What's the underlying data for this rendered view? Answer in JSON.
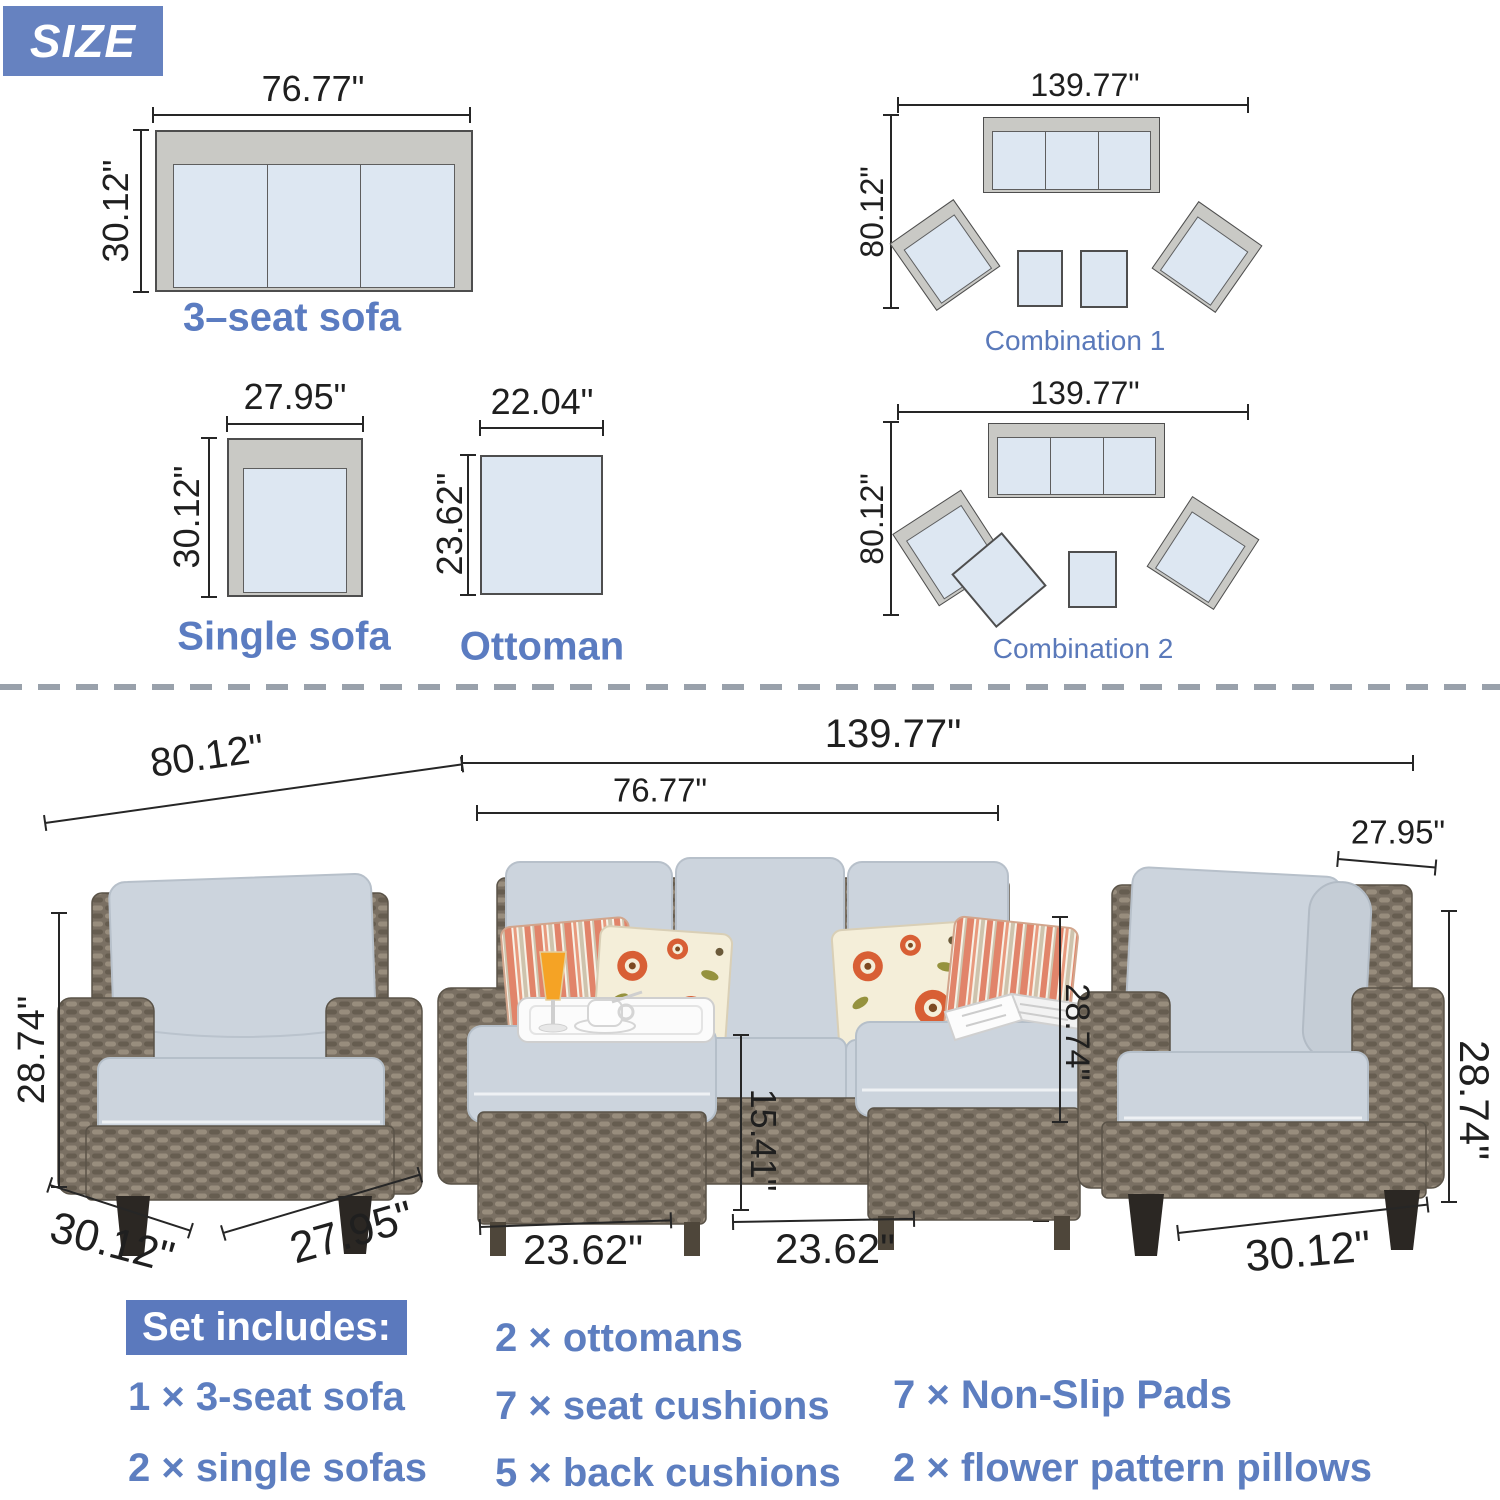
{
  "badge": {
    "label": "SIZE"
  },
  "diagrams": {
    "sofa3": {
      "label": "3–seat sofa",
      "width": "76.77\"",
      "depth": "30.12\""
    },
    "single": {
      "label": "Single sofa",
      "width": "27.95\"",
      "depth": "30.12\""
    },
    "ottoman": {
      "label": "Ottoman",
      "width": "22.04\"",
      "depth": "23.62\""
    },
    "combo1": {
      "label": "Combination 1",
      "width": "139.77\"",
      "depth": "80.12\""
    },
    "combo2": {
      "label": "Combination 2",
      "width": "139.77\"",
      "depth": "80.12\""
    }
  },
  "photo": {
    "depth_total": "80.12\"",
    "width_total": "139.77\"",
    "sofa_width": "76.77\"",
    "right_chair_width": "27.95\"",
    "left_chair_height": "28.74\"",
    "sofa_height": "28.74\"",
    "right_chair_height": "28.74\"",
    "ottoman_height": "15.41\"",
    "ottoman1_width": "23.62\"",
    "ottoman2_width": "23.62\"",
    "left_chair_depth": "30.12\"",
    "left_chair_width": "27.95\"",
    "right_chair_depth": "30.12\""
  },
  "set_includes": {
    "title": "Set includes:",
    "col1": [
      "1 × 3-seat sofa",
      "2 × single sofas"
    ],
    "col2": [
      "2 × ottomans",
      "7 × seat cushions",
      "5 × back cushions"
    ],
    "col3": [
      "7 × Non-Slip Pads",
      "2 × flower pattern pillows"
    ]
  },
  "colors": {
    "accent_blue": "#5b7cc1",
    "badge_blue": "#6682c0",
    "diagram_fill": "#dde7f2",
    "frame_gray": "#c9c9c5",
    "dimension_ink": "#262626"
  }
}
